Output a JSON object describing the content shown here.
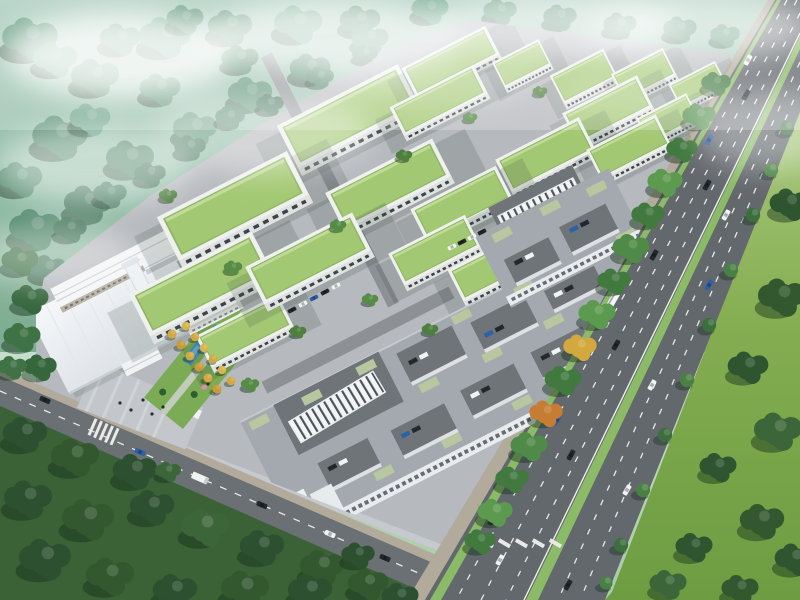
{
  "meta": {
    "title": "Aerial rendering of an industrial park master plan with green-roof warehouses, courtyard dormitory blocks, an arterial highway and surrounding forest",
    "text_content": "none (image contains no readable text)"
  },
  "palette": {
    "sky_top": "#eef7f2",
    "haze_teal": "#a7cabb",
    "forest_teal": "#659a7e",
    "forest_teal_dark": "#4e8066",
    "forest_dark": "#2c5030",
    "forest_mid": "#3c663a",
    "tree_light": "#4e7f3e",
    "lawn_east": "#7aa647",
    "lawn_light": "#9ec47a",
    "campus_concrete": "#b6b9bd",
    "street_gray": "#8d9195",
    "warehouse_roof": "#a3c873",
    "warehouse_wall": "#eff1ee",
    "window_dark": "#3c4349",
    "block_roof": "#a4a9af",
    "court_dark": "#6f7478",
    "sage_roof": "#b8c7a0",
    "white_roof": "#eef1f4",
    "water_blue": "#3e92c8",
    "autumn_gold": "#d3a83f",
    "autumn_orange": "#c67c33",
    "asphalt": "#63686d",
    "road_mark": "#e9eae8",
    "median_green": "#8cbb68",
    "sidewalk_tan": "#b2ab9c",
    "car_dark": "#23282d",
    "car_white": "#f2f4f4",
    "car_blue": "#2e62a8"
  },
  "inventory": {
    "green_roof_warehouses": 19,
    "courtyard_blocks": 2,
    "inner_courtyards": 9,
    "striped_atrium_skylights": 2,
    "admin_complex_buildings": 6,
    "ponds": 3,
    "highway_vehicles": 16,
    "highway_buses": 1,
    "boulevard_vehicles": 6,
    "parked_vehicles": 27,
    "pedestrians": 7
  },
  "legend": {
    "green_roofs": "single/low-rise workshop warehouses with planted flat roofs",
    "gray_blocks": "multi-storey courtyard dormitory/office blocks with sage rooftop terraces",
    "white_complex": "administration and exhibition hall with large white roof",
    "highway": "dual-carriageway arterial road with planted median",
    "boulevard": "secondary access road along the south edge",
    "top_band": "misty hillside forest",
    "bottom_band": "dense dark-green woodland and lawns"
  }
}
